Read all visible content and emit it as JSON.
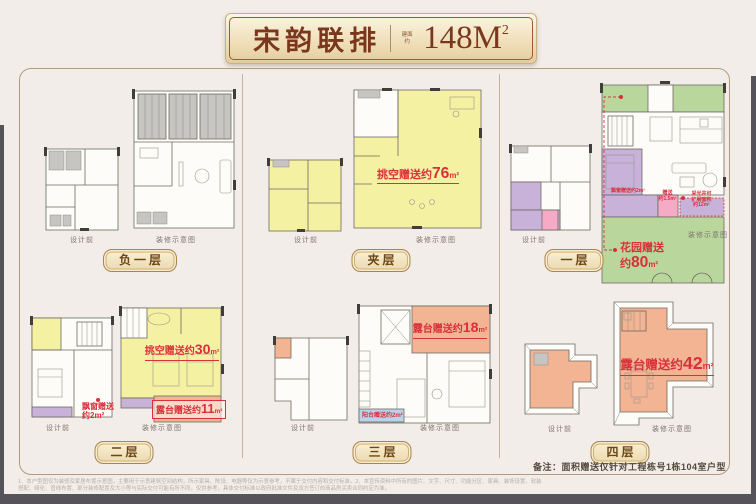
{
  "header": {
    "title": "宋韵联排",
    "seal": "建面约",
    "area": "148M",
    "area_sup": "2"
  },
  "captions": {
    "before": "设计前",
    "after": "装修示意图"
  },
  "floors": {
    "b1": {
      "label": "负一层"
    },
    "mezz": {
      "label": "夹层",
      "void": {
        "pre": "挑空赠送约",
        "num": "76",
        "unit": "m²"
      }
    },
    "f1": {
      "label": "一层",
      "garden": {
        "line1": "花园赠送",
        "pre2": "约",
        "num": "80",
        "unit": "m²"
      },
      "bay": "飘窗赠送约2m²",
      "gift": {
        "l1": "赠送",
        "l2": "约1.5m²"
      },
      "lightwell": {
        "l1": "采光井可",
        "l2": "扩展面积",
        "l3": "约12m²"
      }
    },
    "f2": {
      "label": "二层",
      "void": {
        "pre": "挑空赠送约",
        "num": "30",
        "unit": "m²"
      },
      "terrace": {
        "pre": "露台赠送约",
        "num": "11",
        "unit": "m²"
      },
      "bay": {
        "l1": "飘窗赠送",
        "l2": "约2m²"
      }
    },
    "f3": {
      "label": "三层",
      "terrace": {
        "pre": "露台赠送约",
        "num": "18",
        "unit": "m²"
      },
      "balcony": "阳台赠送约2m²"
    },
    "f4": {
      "label": "四层",
      "terrace": {
        "pre": "露台赠送约",
        "num": "42",
        "unit": "m²"
      }
    }
  },
  "footer": {
    "note": "备注：面积赠送仅针对工程栋号1栋104室户型",
    "fine1": "1、本户型图仅为装修及家居布置示意图，主要用于示意建筑空间结构，所示家具、陈设、电器等仅为示意参考，不属于交付内容和交付标准。2、本宣传资料中所有的图片、文字、尺寸、功能分区、家具、装饰设置、软装",
    "fine2": "搭配、绿化、管线布置、部分装修配置及大小等与实际交付可能有所不同，仅供参考，具体交付标准以政府批准文件及双方签订的商品房买卖合同约定为准。"
  },
  "colors": {
    "accent_red": "#d9303c",
    "yellow": "#f5f1a2",
    "green": "#b9d79d",
    "salmon": "#f2b493",
    "purple": "#c8b2da",
    "pink": "#f5abc6",
    "blue": "#b9d3ea",
    "plaque_text": "#7a371e",
    "badge_border": "#a9854e"
  }
}
